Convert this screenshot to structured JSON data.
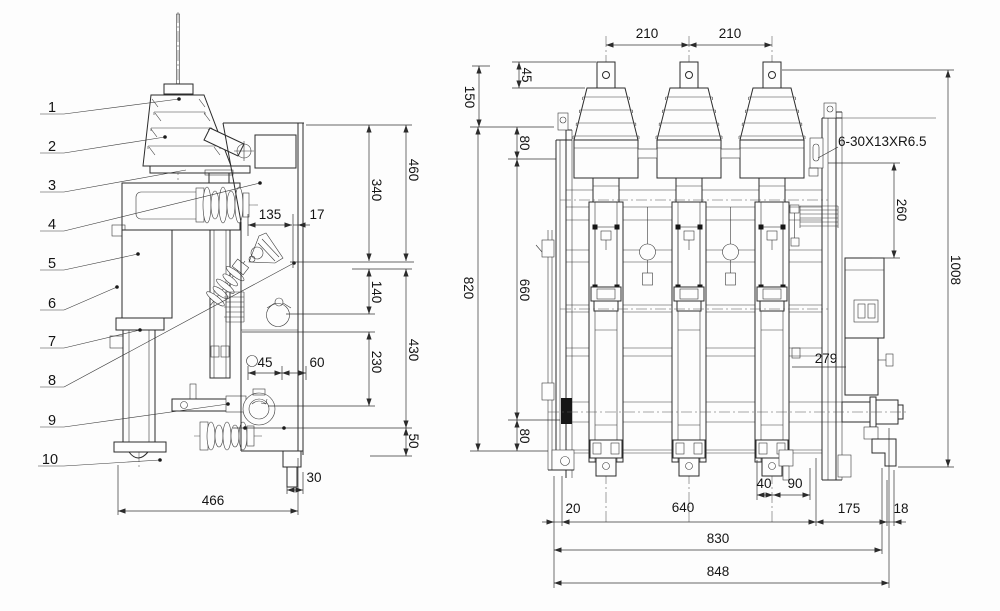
{
  "drawing": {
    "colors": {
      "line": "#2b2b2b",
      "background": "#fdfdfd"
    },
    "side_view": {
      "callouts": [
        {
          "label": "1"
        },
        {
          "label": "2"
        },
        {
          "label": "3"
        },
        {
          "label": "4"
        },
        {
          "label": "5"
        },
        {
          "label": "6"
        },
        {
          "label": "7"
        },
        {
          "label": "8"
        },
        {
          "label": "9"
        },
        {
          "label": "10"
        }
      ],
      "dims": {
        "d460": "460",
        "d340": "340",
        "d135": "135",
        "d17": "17",
        "d140": "140",
        "d430": "430",
        "d230": "230",
        "d45": "45",
        "d60": "60",
        "d50": "50",
        "d30": "30",
        "d466": "466"
      }
    },
    "front_view": {
      "dims": {
        "d210a": "210",
        "d210b": "210",
        "d45": "45",
        "d150": "150",
        "d80a": "80",
        "d820": "820",
        "d660": "660",
        "d80b": "80",
        "d260": "260",
        "d1008": "1008",
        "d279": "279",
        "d40": "40",
        "d90": "90",
        "d20": "20",
        "d640": "640",
        "d175": "175",
        "d18": "18",
        "d830": "830",
        "d848": "848"
      },
      "slot_note": "6-30X13XR6.5"
    }
  }
}
